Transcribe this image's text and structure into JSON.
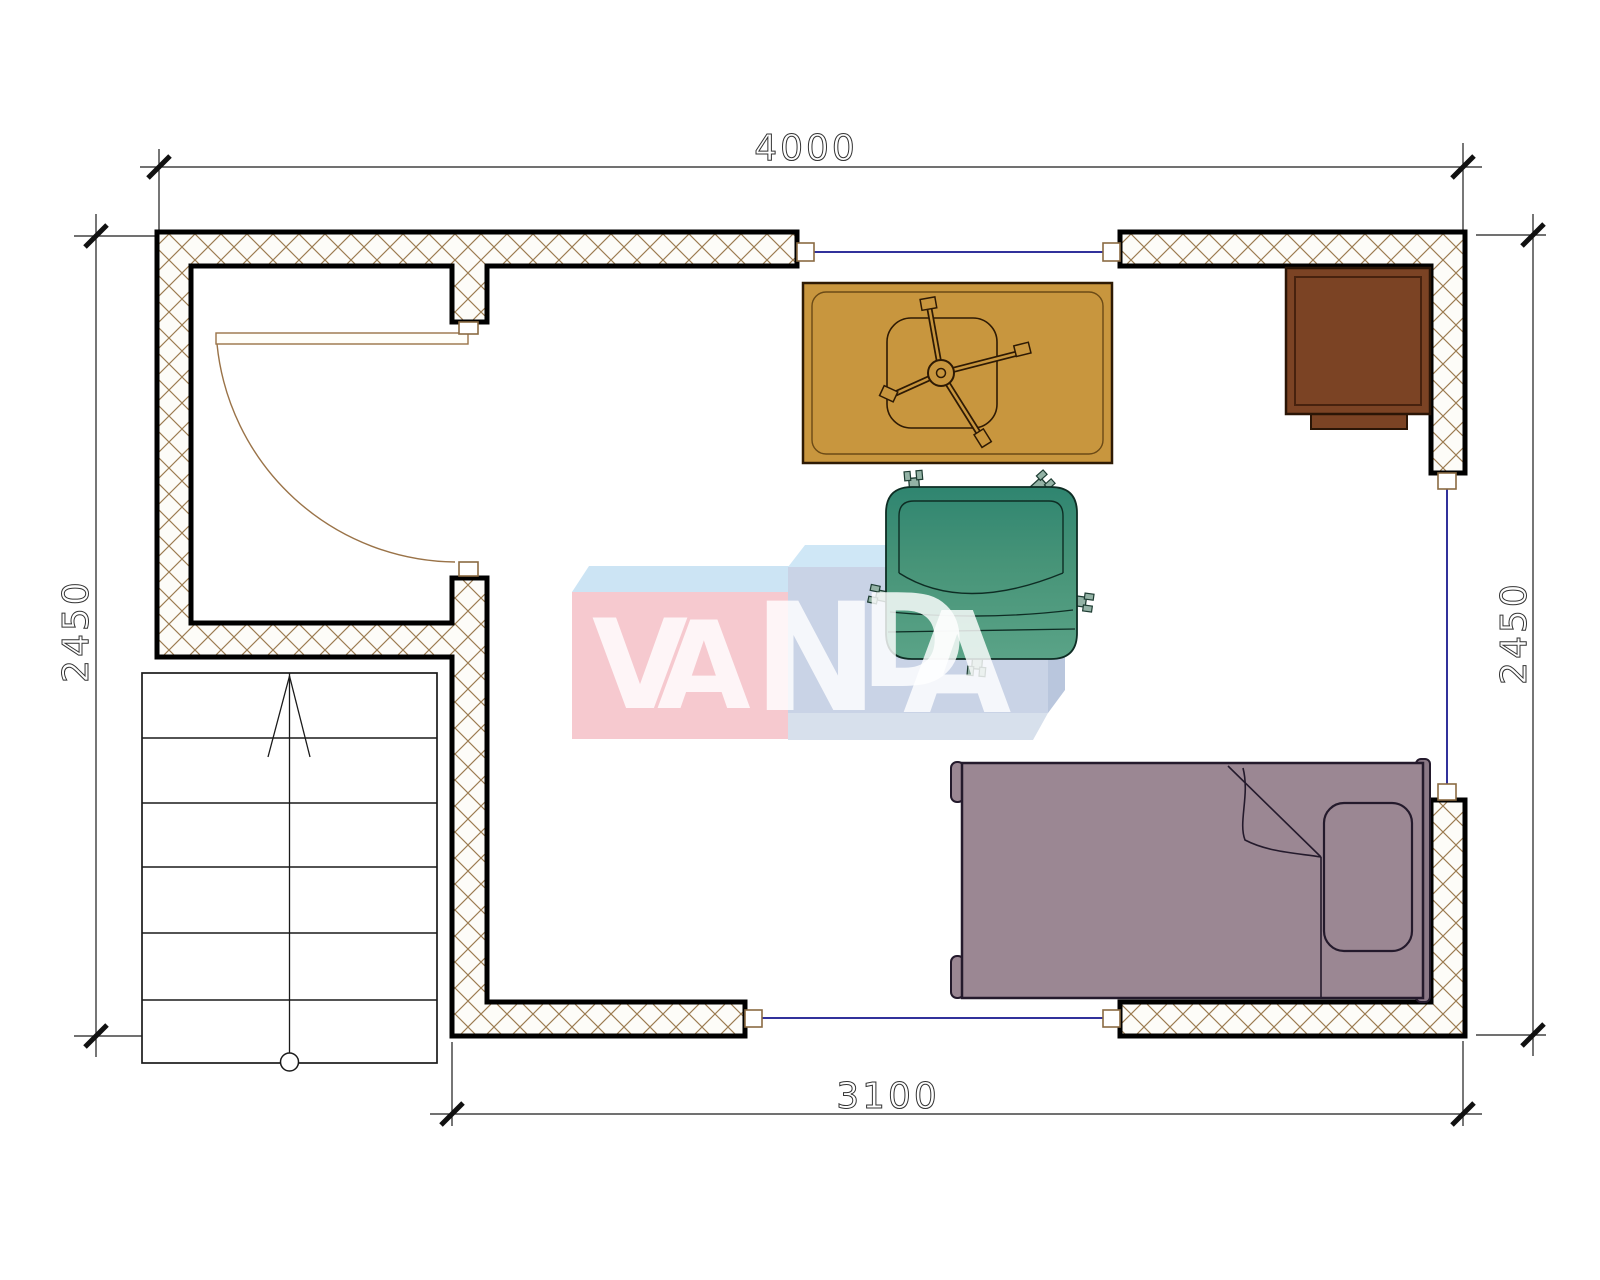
{
  "dimensions": {
    "top": "4000",
    "bottom": "3100",
    "left": "2450",
    "right": "2450"
  },
  "logo": {
    "text": "VANDA",
    "letters": [
      "V",
      "A",
      "N",
      "D",
      "A"
    ],
    "left_box": {
      "front_color": "#f6c9cf",
      "top_color": "#cce4f4"
    },
    "right_box": {
      "front_color": "#c9d3e6",
      "top_color": "#cfe7f6",
      "side_color": "#b9c6dd",
      "bottom_color": "#d7e0ec"
    },
    "text_color": "#ffffff"
  },
  "colors": {
    "wall_hatch": "#9b7b50",
    "wall_outline": "#000000",
    "window_glass": "#31319b",
    "frame_marker": "#8a6a42",
    "door": "#9a7348",
    "table": "#c8963e",
    "table_outline": "#2e1a04",
    "chair": "#4d9a7e",
    "chair_caster": "#93b2a5",
    "bed": "#9b8793",
    "bed_headboard": "#8b7886",
    "bed_outline": "#241a2c",
    "cabinet": "#7b4324",
    "stairs_line": "#1a1a1a",
    "dimension_line": "#1c1c1c"
  },
  "elements": {
    "architecture": [
      "exterior-walls",
      "interior-wall",
      "door-with-swing",
      "window-top",
      "window-bottom",
      "window-right",
      "staircase"
    ],
    "furniture": [
      "desk-table",
      "office-chair-base",
      "armchair",
      "single-bed",
      "pillow",
      "nightstand-cabinet"
    ]
  }
}
